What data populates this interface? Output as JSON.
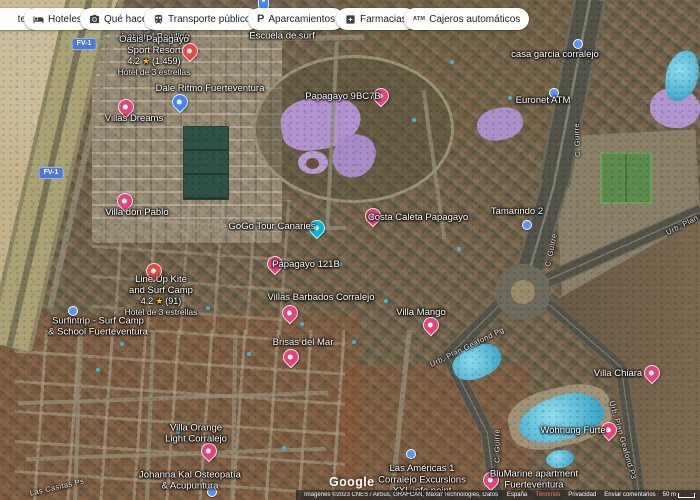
{
  "chips": {
    "partial_left": "tes",
    "items": [
      {
        "id": "hoteles",
        "label": "Hoteles",
        "icon": "bed-icon"
      },
      {
        "id": "que-hacer",
        "label": "Qué hacer",
        "icon": "camera-icon"
      },
      {
        "id": "transporte-publico",
        "label": "Transporte público",
        "icon": "transit-icon"
      },
      {
        "id": "aparcamientos",
        "label": "Aparcamientos",
        "icon": "parking-icon"
      },
      {
        "id": "farmacias",
        "label": "Farmacias",
        "icon": "pharmacy-icon"
      },
      {
        "id": "cajeros-automaticos",
        "label": "Cajeros automáticos",
        "icon": "atm-icon"
      }
    ]
  },
  "map": {
    "star_glyph": "★",
    "route_shields": [
      {
        "text": "FV-1",
        "x": 84,
        "y": 44
      },
      {
        "text": "FV-1",
        "x": 51,
        "y": 173
      }
    ],
    "road_labels": [
      {
        "text": "C. Guirre",
        "x": 577,
        "y": 140,
        "rot": -93
      },
      {
        "text": "C. Guirre",
        "x": 551,
        "y": 250,
        "rot": -78
      },
      {
        "text": "C. Guirre",
        "x": 497,
        "y": 446,
        "rot": -90
      },
      {
        "text": "Urb. Plan Geafond Pg",
        "x": 467,
        "y": 347,
        "rot": -26
      },
      {
        "text": "Urb. Plan Geafond P3",
        "x": 623,
        "y": 440,
        "rot": 74
      },
      {
        "text": "Urb. Plan Ge",
        "x": 688,
        "y": 222,
        "rot": -27
      },
      {
        "text": "Las Casitas Ps",
        "x": 57,
        "y": 487,
        "rot": -13
      }
    ],
    "pois": [
      {
        "id": "papagayo-sports",
        "lines": [
          "Papagayo Sports",
          "bar and Bowling"
        ],
        "x": 156,
        "y": 32
      },
      {
        "id": "escuela-surf",
        "lines": [
          "Fuerteventura",
          "Escuela de surf"
        ],
        "x": 282,
        "y": 31
      },
      {
        "id": "oasis-papagayo",
        "lines": [
          "Oasis Papagayo",
          "Sport Resort"
        ],
        "rating": "4.2",
        "reviews": "(1.459)",
        "sub": "Hotel de 3 estrellas",
        "x": 154,
        "y": 56,
        "pin": {
          "type": "hotel",
          "x": 189,
          "y": 50
        }
      },
      {
        "id": "dale-ritmo",
        "lines": [
          "Dale Ritmo Fuerteventura"
        ],
        "x": 210,
        "y": 89,
        "pin": {
          "type": "blue",
          "x": 179,
          "y": 101
        }
      },
      {
        "id": "villas-dreams",
        "lines": [
          "Villas Dreams"
        ],
        "x": 134,
        "y": 119,
        "pin": {
          "type": "pink",
          "x": 125,
          "y": 106
        }
      },
      {
        "id": "casa-garcia",
        "lines": [
          "casa garcia corralejo"
        ],
        "x": 555,
        "y": 55,
        "pin": {
          "type": "bluedot",
          "x": 577,
          "y": 43
        }
      },
      {
        "id": "papagayo-9bc7b",
        "lines": [
          "Papagayo 9BC7B"
        ],
        "x": 343,
        "y": 97,
        "pin": {
          "type": "pink",
          "x": 380,
          "y": 95
        }
      },
      {
        "id": "euronet-atm",
        "lines": [
          "Euronet ATM"
        ],
        "x": 543,
        "y": 101,
        "pin": {
          "type": "bluedot",
          "x": 553,
          "y": 92
        }
      },
      {
        "id": "villa-don-pablo",
        "lines": [
          "Villa don Pablo"
        ],
        "x": 137,
        "y": 213,
        "pin": {
          "type": "pink",
          "x": 124,
          "y": 200
        }
      },
      {
        "id": "costa-caleta",
        "lines": [
          "Costa Caleta Papagayo"
        ],
        "x": 418,
        "y": 218,
        "pin": {
          "type": "pink",
          "x": 372,
          "y": 215
        }
      },
      {
        "id": "tamarindo-2",
        "lines": [
          "Tamarindo 2"
        ],
        "x": 517,
        "y": 212,
        "pin": {
          "type": "bluedot",
          "x": 526,
          "y": 224
        }
      },
      {
        "id": "gogo-tour",
        "lines": [
          "GoGo Tour Canaries"
        ],
        "x": 272,
        "y": 227,
        "pin": {
          "type": "teal",
          "x": 316,
          "y": 227
        }
      },
      {
        "id": "papagayo-121b",
        "lines": [
          "Papagayo 121B"
        ],
        "x": 306,
        "y": 265,
        "pin": {
          "type": "pink",
          "x": 274,
          "y": 263
        }
      },
      {
        "id": "line-up-kite",
        "lines": [
          "Line Up Kite",
          "and Surf Camp"
        ],
        "rating": "4.2",
        "reviews": "(91)",
        "sub": "Hotel de 3 estrellas",
        "x": 161,
        "y": 296,
        "pin": {
          "type": "hotel",
          "x": 153,
          "y": 270
        }
      },
      {
        "id": "surfintrip",
        "lines": [
          "Surfintrip - Surf Camp",
          "& School Fuerteventura"
        ],
        "x": 98,
        "y": 327,
        "pin": {
          "type": "bluedot",
          "x": 72,
          "y": 310
        }
      },
      {
        "id": "villas-barbados",
        "lines": [
          "Villas Barbados Corralejo"
        ],
        "x": 321,
        "y": 298,
        "pin": {
          "type": "pink",
          "x": 289,
          "y": 312
        }
      },
      {
        "id": "villa-mango",
        "lines": [
          "Villa Mango"
        ],
        "x": 421,
        "y": 313,
        "pin": {
          "type": "pink",
          "x": 430,
          "y": 324
        }
      },
      {
        "id": "brisas-del-mar",
        "lines": [
          "Brisas del Mar"
        ],
        "x": 303,
        "y": 343,
        "pin": {
          "type": "pink",
          "x": 290,
          "y": 356
        }
      },
      {
        "id": "villa-chiara",
        "lines": [
          "Villa Chiara"
        ],
        "x": 618,
        "y": 374,
        "pin": {
          "type": "pink",
          "x": 651,
          "y": 372
        }
      },
      {
        "id": "wohnung-fuerte",
        "lines": [
          "Wohnung Fürte"
        ],
        "x": 573,
        "y": 431,
        "pin": {
          "type": "pink",
          "x": 608,
          "y": 429
        }
      },
      {
        "id": "villa-orange",
        "lines": [
          "Villa Orange",
          "Light Corralejo"
        ],
        "x": 196,
        "y": 434,
        "pin": {
          "type": "pink",
          "x": 208,
          "y": 450
        }
      },
      {
        "id": "johanna-kal",
        "lines": [
          "Johanna Kal Osteopatía",
          "& Acupuntura"
        ],
        "x": 190,
        "y": 481,
        "pin": {
          "type": "bluedot",
          "x": 211,
          "y": 491
        }
      },
      {
        "id": "las-americas-1",
        "lines": [
          "Las Américas 1"
        ],
        "x": 422,
        "y": 469,
        "pin": {
          "type": "bluedot",
          "x": 410,
          "y": 453
        }
      },
      {
        "id": "blumarine",
        "lines": [
          "BluMarine apartment",
          "Fuerteventura"
        ],
        "x": 534,
        "y": 480,
        "pin": {
          "type": "pink",
          "x": 490,
          "y": 479
        }
      },
      {
        "id": "corralejo-excursions",
        "lines": [
          "Corralejo Excursions",
          "XXL info point"
        ],
        "x": 422,
        "y": 486
      },
      {
        "id": "transit-stop-top",
        "pin": {
          "type": "mini",
          "x": 262,
          "y": 3
        }
      }
    ]
  },
  "footer": {
    "logo": "Google",
    "attribution": "Imágenes ©2023 CNES / Airbus, GRAFCAN, Maxar Technologies, Datos del mapa ©2023",
    "links": [
      "España",
      "Términos",
      "Privacidad",
      "Enviar comentarios"
    ],
    "scale_label": "50 m"
  },
  "colors": {
    "pin_pink": "#e0457c",
    "pin_red": "#e34a4a",
    "pin_blue": "#4285f4",
    "poi_dot": "#5b93f5",
    "pin_teal": "#00b8d4",
    "shield_blue": "#4d79d6",
    "star_yellow": "#fbbc04"
  }
}
